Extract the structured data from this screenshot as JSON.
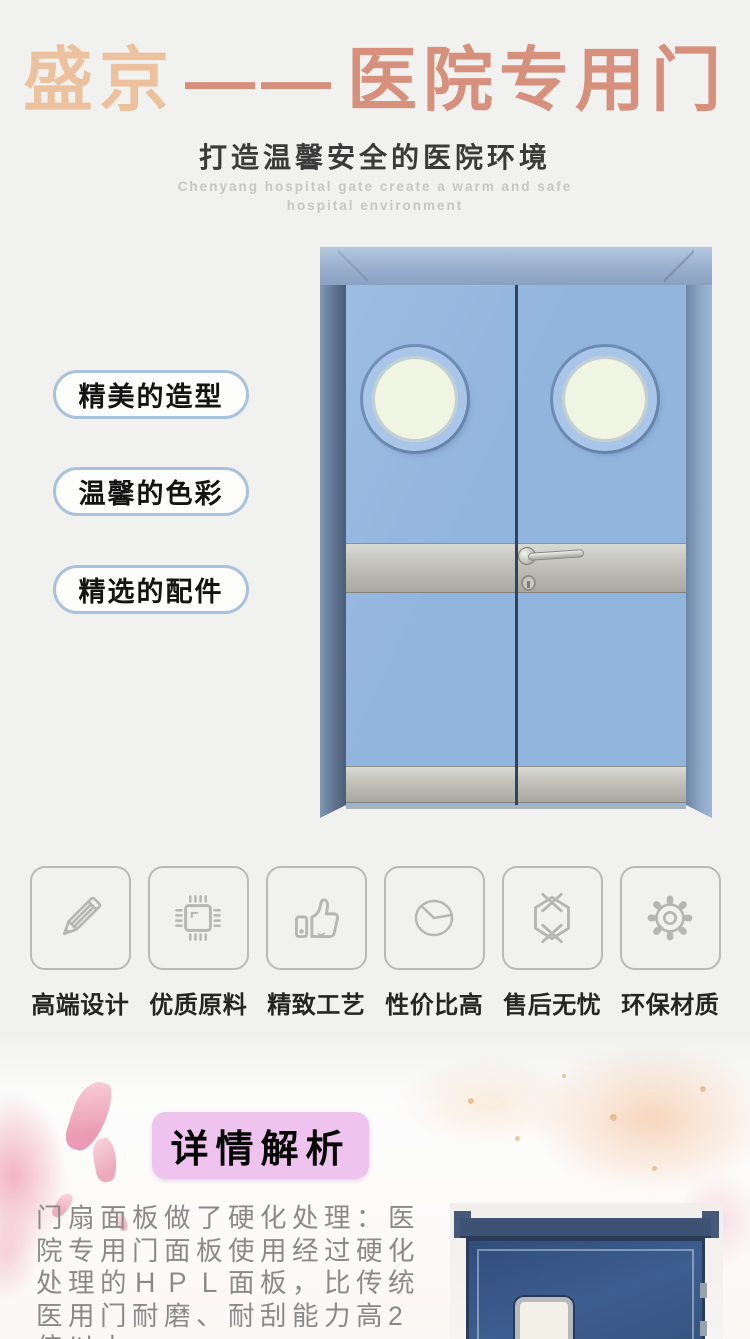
{
  "header": {
    "brand_primary": "盛京",
    "brand_dash": "——",
    "brand_secondary": "医院专用门",
    "subtitle": "打造温馨安全的医院环境",
    "subtitle_en": "Chenyang hospital gate create a warm and safe hospital environment"
  },
  "hero": {
    "labels": [
      {
        "text": "精美的造型"
      },
      {
        "text": "温馨的色彩"
      },
      {
        "text": "精选的配件"
      }
    ],
    "door": {
      "type": "double swing hospital door",
      "leaf_color": "#92b5de",
      "frame_color": "#8aa1c1",
      "window": "round porthole x2",
      "bands": "stainless steel mid band and kick plate"
    }
  },
  "features": {
    "items": [
      {
        "icon": "pencil-icon",
        "label": "高端设计"
      },
      {
        "icon": "chip-icon",
        "label": "优质原料"
      },
      {
        "icon": "thumbs-up-icon",
        "label": "精致工艺"
      },
      {
        "icon": "pie-chart-icon",
        "label": "性价比高"
      },
      {
        "icon": "package-icon",
        "label": "售后无忧"
      },
      {
        "icon": "gear-icon",
        "label": "环保材质"
      }
    ]
  },
  "detail": {
    "badge": "详情解析",
    "paragraph_lines": [
      "门扇面板做了硬化处理：医",
      "院专用门面板使用经过硬化",
      "处理的ＨＰＬ面板，比传统",
      "医用门耐磨、耐刮能力高2",
      "倍以上"
    ]
  },
  "colors": {
    "page_bg": "#f1f1ef",
    "brand_peach": "#ecc29e",
    "brand_salmon": "#d6907c",
    "subtitle_dark": "#3b3b3b",
    "subtitle_en_gray": "#c6c6c6",
    "pill_border_blue": "#a7c2dc",
    "door_leaf_blue": "#92b5de",
    "porthole_glass": "#f0f4e2",
    "steel_band": "#c3c3bc",
    "icon_gray": "#b6b6b6",
    "badge_pink": "#eec3ee",
    "paragraph_gray": "#8a8a8a",
    "photo_door_navy": "#35547f"
  }
}
